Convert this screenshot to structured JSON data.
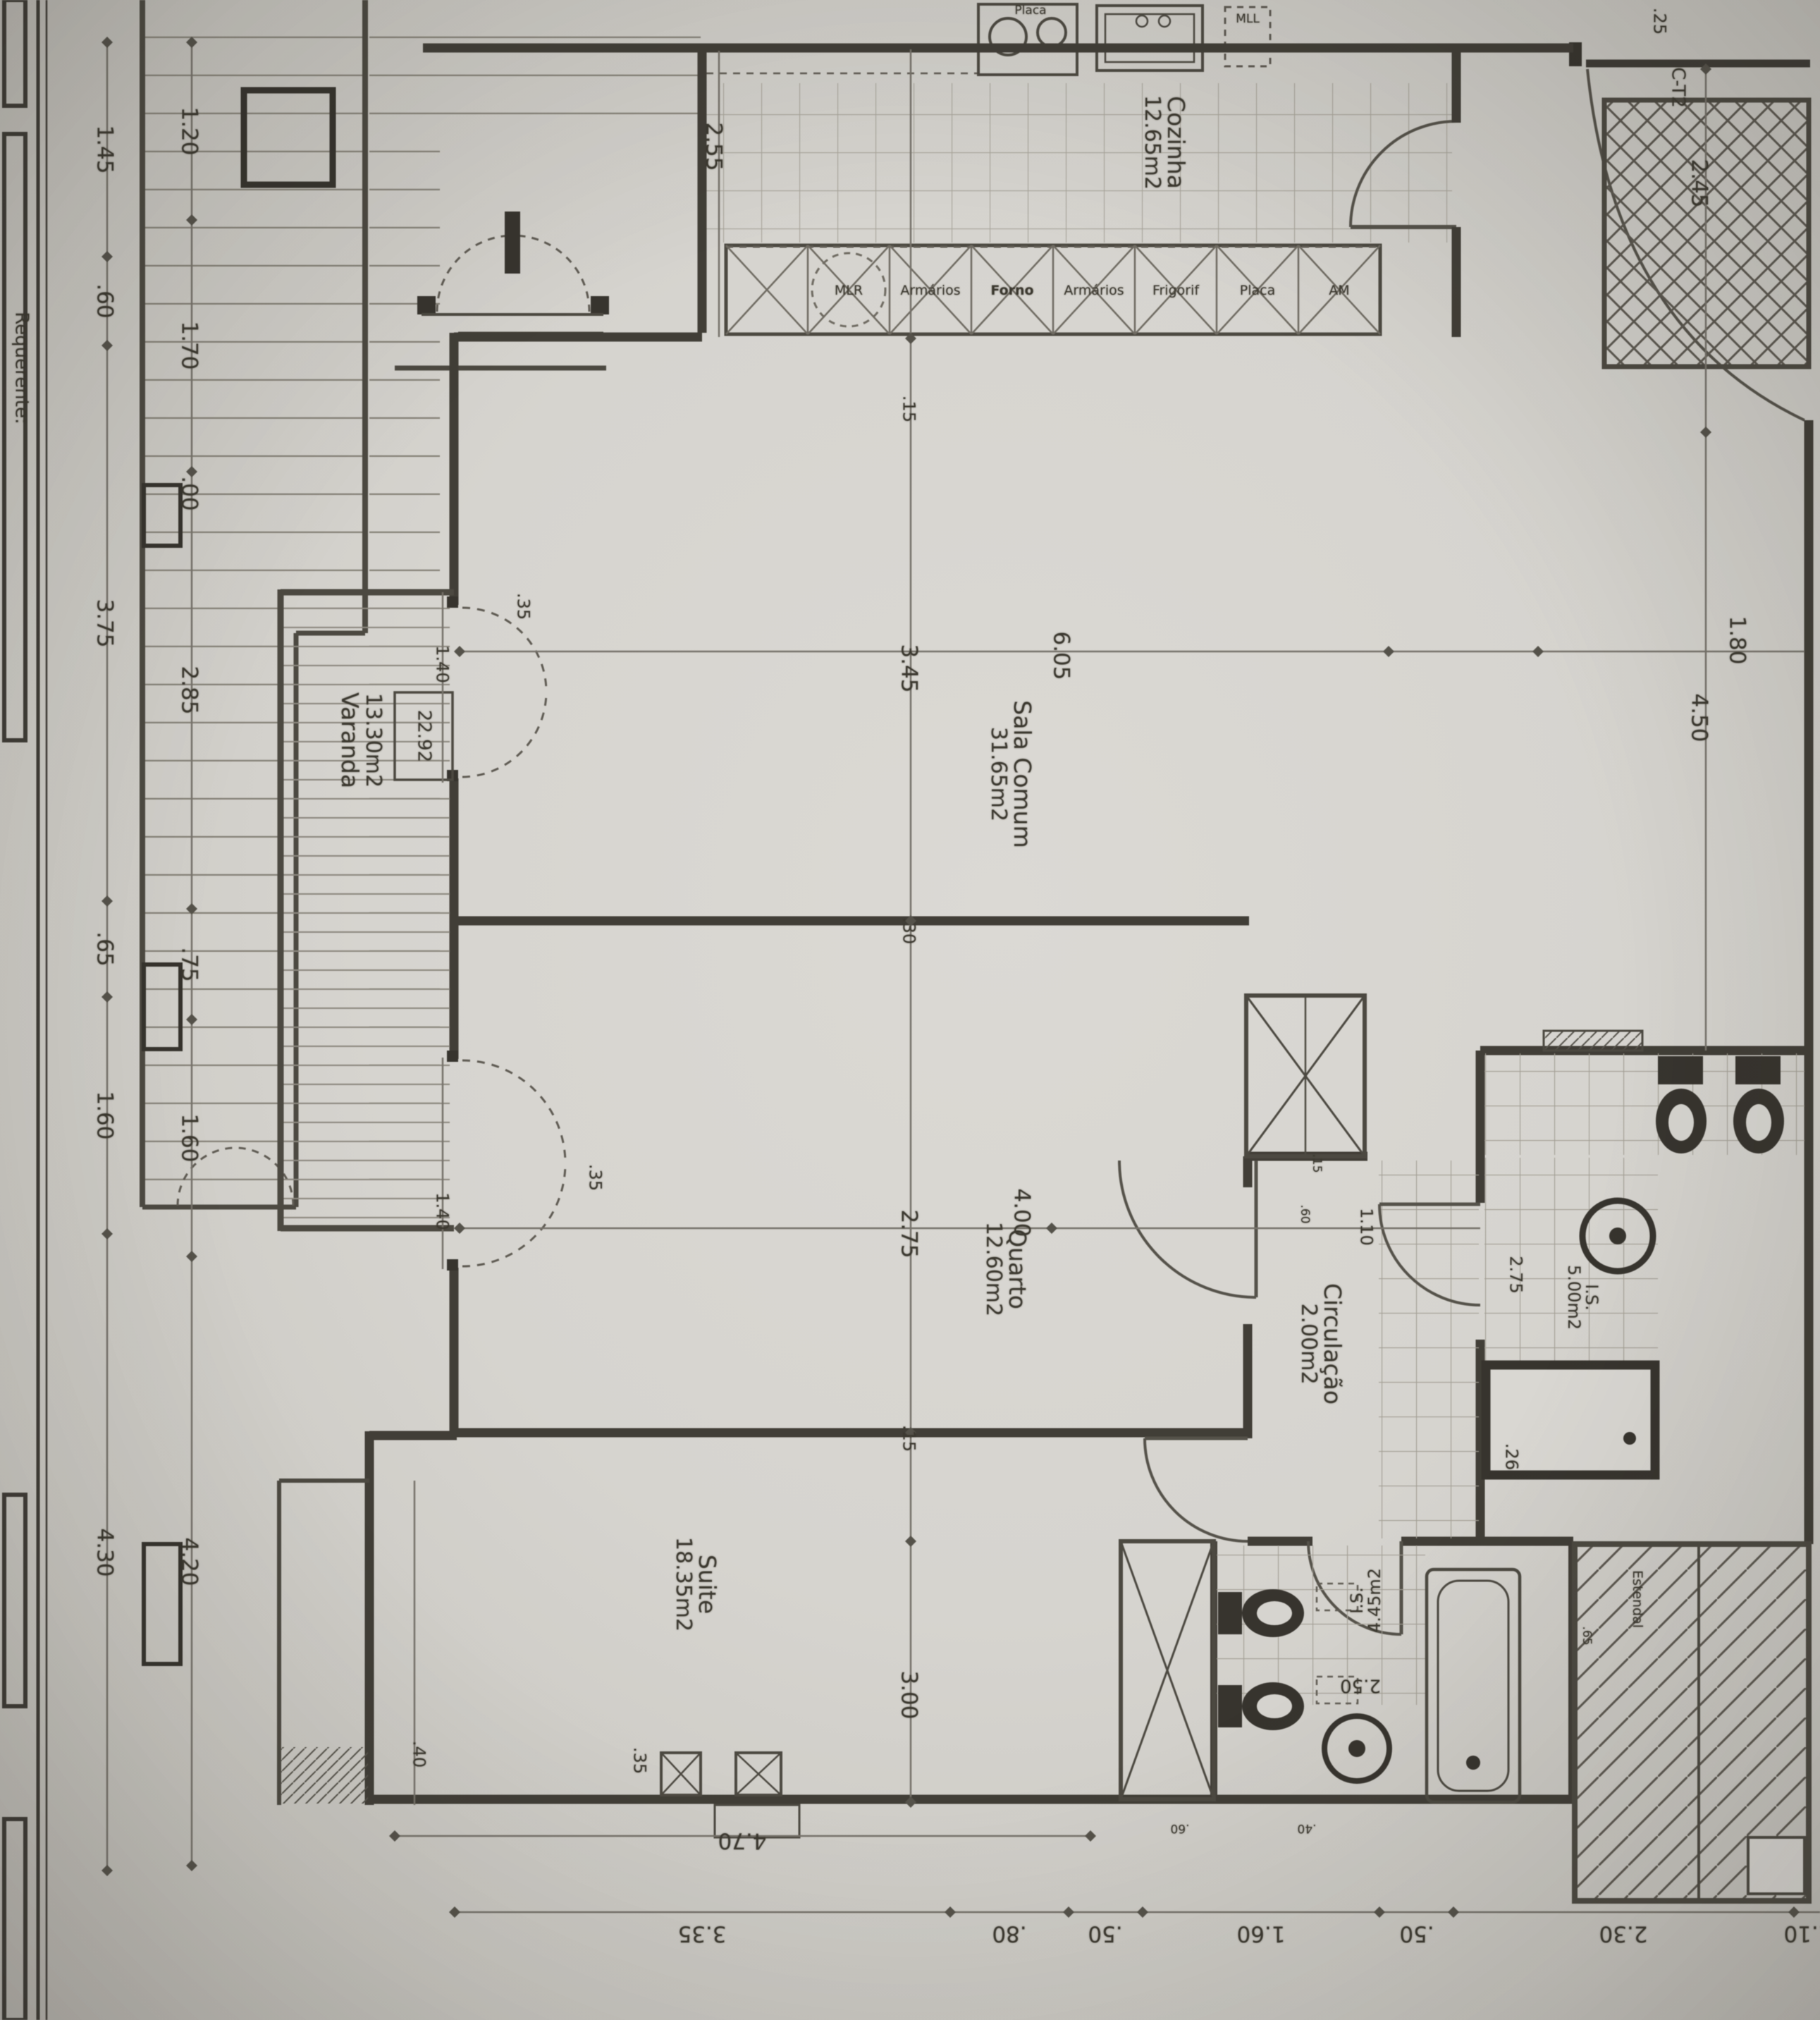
{
  "annotations": {
    "unit": "C-T2",
    "level": "22.92",
    "requester": "Requerente:"
  },
  "rooms": [
    {
      "name": "Cozinha",
      "area": "12.65m2"
    },
    {
      "name": "Sala Comum",
      "area": "31.65m2"
    },
    {
      "name": "Varanda",
      "area": "13.30m2"
    },
    {
      "name": "Quarto",
      "area": "12.60m2"
    },
    {
      "name": "Circulação",
      "area": "2.00m2"
    },
    {
      "name": "I.S.",
      "area": "5.00m2"
    },
    {
      "name": "Suite",
      "area": "18.35m2"
    },
    {
      "name": "I.S.",
      "area": "4.45m2"
    },
    {
      "name": "Estendal",
      "area": ""
    }
  ],
  "appliances": [
    "MLR",
    "Armários",
    "Forno",
    "Armários",
    "Frigorif",
    "Placa",
    "AM"
  ],
  "fixtures": {
    "hob": "Placa",
    "dishwasher": "MLL"
  },
  "dims": {
    "left_outer": [
      "1.45",
      ".60",
      "3.75",
      ".65",
      "1.60",
      "4.30"
    ],
    "left_inner": [
      "1.20",
      "1.70",
      ".00",
      "2.85",
      ".75",
      "1.60",
      "4.20"
    ],
    "bottom": [
      "3.35",
      ".80",
      ".50",
      "1.60",
      ".50",
      "2.30",
      "1.10"
    ],
    "interior": [
      "6.05",
      "3.45",
      ".15",
      ".30",
      "2.75",
      "4.00",
      ".15",
      "3.00",
      ".35",
      "4.70",
      "1.10",
      "1.80",
      "4.50",
      "2.45",
      "2.55",
      ".25",
      ".35",
      "1.40",
      ".35",
      "1.40",
      "2.75",
      ".26",
      "2.50",
      ".15",
      ".60",
      ".60",
      ".40",
      ".40",
      ".65"
    ]
  }
}
